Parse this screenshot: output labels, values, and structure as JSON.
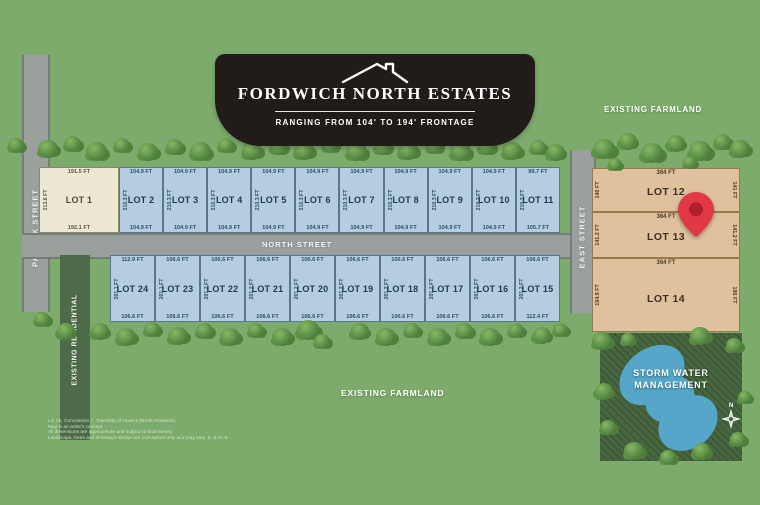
{
  "banner": {
    "title": "FORDWICH NORTH ESTATES",
    "subtitle": "RANGING FROM 104' TO 194' FRONTAGE"
  },
  "streets": {
    "patrick": "PATRICK STREET",
    "north": "NORTH STREET",
    "east": "EAST STREET"
  },
  "area_labels": {
    "farmland_top": "EXISTING FARMLAND",
    "farmland_bottom": "EXISTING FARMLAND",
    "residential": "EXISTING RESIDENTIAL",
    "storm_water_line1": "STORM WATER",
    "storm_water_line2": "MANAGEMENT",
    "compass_north": "N"
  },
  "lots": {
    "top_row": [
      {
        "name": "LOT 1",
        "front": "191.5 FT",
        "rear": "192.1 FT",
        "side": "213.6 FT",
        "premium": true
      },
      {
        "name": "LOT 2",
        "front": "104.9 FT",
        "rear": "104.9 FT",
        "side": "210.3 FT"
      },
      {
        "name": "LOT 3",
        "front": "104.9 FT",
        "rear": "104.9 FT",
        "side": "210.3 FT"
      },
      {
        "name": "LOT 4",
        "front": "104.9 FT",
        "rear": "104.9 FT",
        "side": "210.3 FT"
      },
      {
        "name": "LOT 5",
        "front": "104.9 FT",
        "rear": "104.9 FT",
        "side": "210.3 FT"
      },
      {
        "name": "LOT 6",
        "front": "104.9 FT",
        "rear": "104.9 FT",
        "side": "210.3 FT"
      },
      {
        "name": "LOT 7",
        "front": "104.9 FT",
        "rear": "104.9 FT",
        "side": "210.3 FT"
      },
      {
        "name": "LOT 8",
        "front": "104.9 FT",
        "rear": "104.9 FT",
        "side": "210.3 FT"
      },
      {
        "name": "LOT 9",
        "front": "104.9 FT",
        "rear": "104.9 FT",
        "side": "210.3 FT"
      },
      {
        "name": "LOT 10",
        "front": "104.9 FT",
        "rear": "104.9 FT",
        "side": "210.3 FT"
      },
      {
        "name": "LOT 11",
        "front": "99.7 FT",
        "rear": "105.7 FT",
        "side": "210.3 FT"
      }
    ],
    "bottom_row": [
      {
        "name": "LOT 24",
        "front": "112.9 FT",
        "rear": "106.6 FT",
        "side": "201.1 FT"
      },
      {
        "name": "LOT 23",
        "front": "106.6 FT",
        "rear": "106.6 FT",
        "side": "201.1 FT"
      },
      {
        "name": "LOT 22",
        "front": "106.6 FT",
        "rear": "106.6 FT",
        "side": "201.2 FT"
      },
      {
        "name": "LOT 21",
        "front": "106.6 FT",
        "rear": "106.6 FT",
        "side": "201.2 FT"
      },
      {
        "name": "LOT 20",
        "front": "106.6 FT",
        "rear": "106.6 FT",
        "side": "201.2 FT"
      },
      {
        "name": "LOT 19",
        "front": "106.6 FT",
        "rear": "106.6 FT",
        "side": "201.2 FT"
      },
      {
        "name": "LOT 18",
        "front": "106.6 FT",
        "rear": "106.6 FT",
        "side": "201.2 FT"
      },
      {
        "name": "LOT 17",
        "front": "106.6 FT",
        "rear": "106.6 FT",
        "side": "201.2 FT"
      },
      {
        "name": "LOT 16",
        "front": "106.6 FT",
        "rear": "106.6 FT",
        "side": "201.2 FT"
      },
      {
        "name": "LOT 15",
        "front": "106.6 FT",
        "rear": "112.4 FT",
        "side": "201.2 FT"
      }
    ],
    "east_column": [
      {
        "name": "LOT 12",
        "front": "364 FT",
        "left": "140 FT",
        "right": "141 FT",
        "height": 44
      },
      {
        "name": "LOT 13",
        "front": "364 FT",
        "left": "141.2 FT",
        "right": "141.2 FT",
        "height": 46
      },
      {
        "name": "LOT 14",
        "front": "364 FT",
        "left": "194.9 FT",
        "right": "195 FT",
        "height": 74
      }
    ]
  },
  "disclaimer": [
    "Lot 25, Concession 7, Township of Howick (North Fordwich)",
    "Map is an artist's concept.",
    "All dimensions are approximate and subject to final survey.",
    "Landscape, trees and driveways shown are conceptual only and may vary. E. & O. E."
  ],
  "colors": {
    "background": "#7CAB6B",
    "banner": "#211C19",
    "standard_lot": "#B5CEDF",
    "premium_lot": "#ECE8D2",
    "east_lot": "#DFC19E",
    "road": "#9AA19D",
    "residential_zone": "#4E6B49",
    "storm_zone": "#47663F",
    "pond": "#55A6C8",
    "pin": "#E23744"
  }
}
